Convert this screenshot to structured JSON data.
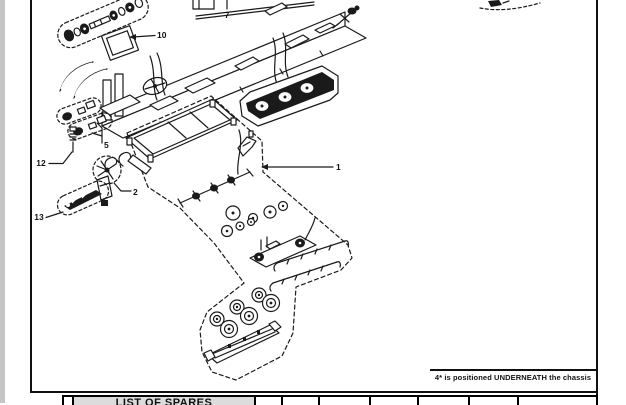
{
  "diagram": {
    "note": "4* is positioned UNDERNEATH the chassis",
    "part_labels": {
      "l1": "1",
      "l2": "2",
      "l5": "5",
      "l7": "7",
      "l10": "10",
      "l12": "12",
      "l13": "13"
    }
  },
  "spares_table": {
    "header": "LIST OF SPARES"
  },
  "colors": {
    "ink": "#1a1a1a",
    "table_header_bg": "#dcdcdc",
    "page_edge_strip": "#c5c5c5",
    "paper": "#ffffff"
  }
}
